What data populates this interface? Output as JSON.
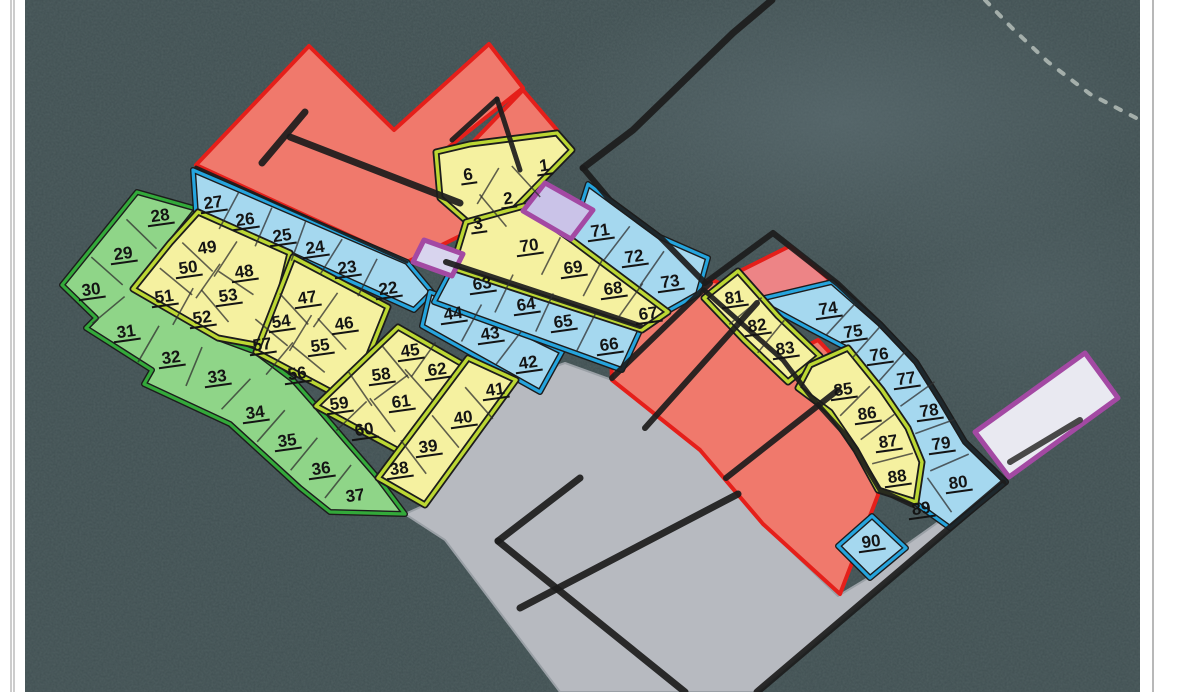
{
  "map": {
    "width": 1179,
    "height": 692,
    "description": "Subdivision plot plan over aerial forest photo, numbered land parcels",
    "colors": {
      "page_bg": "#ffffff",
      "forest": "#414f52",
      "forest_light": "#5d6d6e",
      "gray": "#b7bac0",
      "gray_edge": "#9aa0a6",
      "red_fill": "#f0796c",
      "red_fill_alt": "#ed8486",
      "red_stroke": "#e51f1a",
      "yellow_fill": "#f5f1a0",
      "yellow_stroke": "#bcd733",
      "blue_fill": "#a5d8ef",
      "blue_stroke": "#25a4dd",
      "green_fill": "#8fd588",
      "green_stroke": "#33a93a",
      "purple_stroke": "#a349a3",
      "purple_fill_1": "#cac3e8",
      "purple_fill_2": "#d8d4ee",
      "purple_fill_3": "#e9e9f1",
      "road": "#1c1c1c",
      "divider": "#2f2f2f",
      "label": "#141414",
      "trail": "#d6ddd6",
      "margin_line": "#999999"
    },
    "zones": [
      {
        "id": "gray-clearing",
        "sty": "gray",
        "pts": "565,363 612,380 700,450 763,524 838,596 868,578 906,545 958,508 1003,483 757,692 560,692 445,540 405,514 425,505 516,380"
      },
      {
        "id": "red-north-M",
        "sty": "red",
        "pts": "196,165 309,46 394,130 489,44 523,88 445,150 500,190 540,238 468,232 407,262"
      },
      {
        "id": "red-north-band",
        "sty": "red",
        "pts": "523,90 557,130 505,173 472,143"
      },
      {
        "id": "red-middle",
        "sty": "red",
        "pts": "609,301 652,282 715,281 757,302 800,348 838,387 860,416 875,460 878,495 840,594 763,524 700,450 612,380"
      },
      {
        "id": "red-east-top",
        "sty": "red",
        "fill": "#ed8486",
        "pts": "738,272 790,246 830,280 776,318"
      },
      {
        "id": "red-east-mid",
        "sty": "red",
        "pts": "786,356 818,340 848,372 815,395"
      },
      {
        "id": "green-band",
        "sty": "green",
        "pts": "137,192 62,285 96,318 86,328 152,370 144,384 230,424 300,488 330,512 405,514 378,478 345,440 316,406 293,380 256,352 218,338 196,320 133,289 170,243 197,209"
      },
      {
        "id": "blue-band-22-27",
        "sty": "blue",
        "pts": "193,170 407,262 432,292 414,310 290,254 196,214"
      },
      {
        "id": "blue-band-42-44",
        "sty": "blue",
        "pts": "430,292 468,306 562,352 540,392 422,326"
      },
      {
        "id": "blue-band-63-66",
        "sty": "blue",
        "pts": "454,264 644,322 622,370 434,302"
      },
      {
        "id": "blue-band-71-73",
        "sty": "blue",
        "pts": "588,184 660,237 708,258 698,294 666,312 570,240"
      },
      {
        "id": "blue-band-74-80",
        "sty": "blue",
        "pts": "756,300 832,282 880,324 916,362 940,400 965,442 1006,482 950,528 914,502 920,462 906,428 880,390 846,348 808,328"
      },
      {
        "id": "blue-plot-90",
        "sty": "blue",
        "pts": "838,546 872,516 906,548 870,578"
      },
      {
        "id": "yellow-block-49-53",
        "sty": "yellow",
        "pts": "198,212 290,253 267,347 218,338 133,289 170,243"
      },
      {
        "id": "yellow-block-46-57",
        "sty": "yellow",
        "pts": "293,257 388,307 350,402 256,352"
      },
      {
        "id": "yellow-block-45-62",
        "sty": "yellow",
        "pts": "398,327 466,366 430,468 316,406"
      },
      {
        "id": "yellow-block-38-41",
        "sty": "yellow",
        "pts": "468,358 516,380 425,505 378,478"
      },
      {
        "id": "yellow-block-1-6",
        "sty": "yellow",
        "pts": "436,152 470,144 557,133 572,150 486,238 440,198"
      },
      {
        "id": "yellow-band-67-70",
        "sty": "yellow",
        "pts": "466,222 524,206 572,240 668,312 642,330 452,268"
      },
      {
        "id": "yellow-band-81-83",
        "sty": "yellow",
        "pts": "704,298 738,271 778,316 820,356 788,382 744,340"
      },
      {
        "id": "yellow-band-85-88",
        "sty": "yellow",
        "pts": "810,365 848,348 882,390 908,428 922,462 916,502 878,490 856,450 830,412 798,388"
      },
      {
        "id": "purple-plot-north",
        "sty": "purple",
        "fill": "#cac3e8",
        "pts": "545,183 593,210 571,239 523,211"
      },
      {
        "id": "purple-plot-small",
        "sty": "purple",
        "fill": "#d8d4ee",
        "pts": "424,240 463,254 452,276 413,262"
      },
      {
        "id": "purple-plot-east",
        "sty": "purple",
        "fill": "#e9e9f1",
        "pts": "1085,353 1118,398 1009,477 975,432"
      }
    ],
    "roads": [
      {
        "id": "road-top-diagonal",
        "pts": "772,0 733,33 633,130 583,168",
        "w": 7
      },
      {
        "id": "road-ne-71-73",
        "pts": "583,168 610,200 660,237 705,283",
        "w": 6
      },
      {
        "id": "road-ne-boundary",
        "pts": "705,283 773,233 838,284 880,324 916,362 940,400 965,442 993,469 1006,482",
        "w": 6
      },
      {
        "id": "road-red-strip-boundary",
        "pts": "704,290 783,360 812,398 850,440 880,490 912,505",
        "w": 5
      },
      {
        "id": "road-band-63",
        "pts": "446,262 640,326",
        "w": 6
      },
      {
        "id": "road-red-blue-edge",
        "pts": "196,167 407,262",
        "w": 3
      },
      {
        "id": "road-red-T-short",
        "pts": "262,163 305,112",
        "w": 7
      },
      {
        "id": "road-red-T-long",
        "pts": "290,137 460,203",
        "w": 7
      },
      {
        "id": "road-red-r1",
        "pts": "452,140 497,99",
        "w": 5
      },
      {
        "id": "road-red-r2",
        "pts": "497,99 520,170",
        "w": 5
      },
      {
        "id": "road-redmid-s1",
        "pts": "710,283 612,378",
        "w": 6
      },
      {
        "id": "road-redmid-s2",
        "pts": "757,303 645,428",
        "w": 6
      },
      {
        "id": "road-redmid-s3",
        "pts": "838,390 726,478",
        "w": 6
      },
      {
        "id": "road-gray-a",
        "pts": "580,478 498,541",
        "w": 7
      },
      {
        "id": "road-gray-b",
        "pts": "498,541 685,692",
        "w": 7
      },
      {
        "id": "road-gray-c",
        "pts": "520,608 738,494",
        "w": 7
      },
      {
        "id": "road-gray-d",
        "pts": "757,692 1003,483",
        "w": 7
      },
      {
        "id": "road-purple-east-inner",
        "pts": "1080,420 1010,462",
        "w": 6,
        "c": "#3a3a3a"
      }
    ],
    "trail": {
      "id": "forest-trail",
      "pts": "985,0 1012,28 1048,62 1090,94 1140,120",
      "dash": "6 11",
      "w": 4
    },
    "plots": [
      [
        "1",
        544,
        165,
        "y",
        1
      ],
      [
        "2",
        508,
        198,
        "y",
        1
      ],
      [
        "3",
        478,
        223,
        "y",
        1
      ],
      [
        "6",
        468,
        174,
        "y",
        1
      ],
      [
        "22",
        388,
        288,
        "b",
        1
      ],
      [
        "23",
        347,
        267,
        "b",
        1
      ],
      [
        "24",
        315,
        247,
        "b",
        1
      ],
      [
        "25",
        282,
        235,
        "b",
        1
      ],
      [
        "26",
        245,
        219,
        "b",
        1
      ],
      [
        "27",
        213,
        202,
        "b",
        1
      ],
      [
        "28",
        160,
        215,
        "g",
        1
      ],
      [
        "29",
        123,
        253,
        "g",
        1
      ],
      [
        "30",
        91,
        289,
        "g",
        1
      ],
      [
        "31",
        126,
        331,
        "g",
        1
      ],
      [
        "32",
        171,
        357,
        "g",
        1
      ],
      [
        "33",
        217,
        376,
        "g",
        1
      ],
      [
        "34",
        255,
        412,
        "g",
        1
      ],
      [
        "35",
        287,
        440,
        "g",
        1
      ],
      [
        "36",
        321,
        468,
        "g",
        1
      ],
      [
        "37",
        355,
        495,
        "g",
        0
      ],
      [
        "38",
        399,
        468,
        "y",
        1
      ],
      [
        "39",
        428,
        446,
        "y",
        1
      ],
      [
        "40",
        463,
        417,
        "y",
        1
      ],
      [
        "41",
        495,
        389,
        "y",
        1
      ],
      [
        "42",
        528,
        362,
        "b",
        1
      ],
      [
        "43",
        490,
        333,
        "b",
        1
      ],
      [
        "44",
        453,
        313,
        "b",
        1
      ],
      [
        "45",
        410,
        350,
        "y",
        1
      ],
      [
        "46",
        344,
        323,
        "y",
        1
      ],
      [
        "47",
        307,
        297,
        "y",
        1
      ],
      [
        "48",
        244,
        271,
        "y",
        1
      ],
      [
        "49",
        207,
        247,
        "y",
        0
      ],
      [
        "50",
        188,
        267,
        "y",
        1
      ],
      [
        "51",
        164,
        296,
        "y",
        1
      ],
      [
        "52",
        202,
        317,
        "y",
        1
      ],
      [
        "53",
        228,
        295,
        "y",
        1
      ],
      [
        "54",
        281,
        321,
        "y",
        1
      ],
      [
        "55",
        320,
        345,
        "y",
        1
      ],
      [
        "56",
        297,
        373,
        "y",
        1
      ],
      [
        "57",
        262,
        344,
        "y",
        1
      ],
      [
        "58",
        381,
        374,
        "y",
        1
      ],
      [
        "59",
        339,
        403,
        "y",
        1
      ],
      [
        "60",
        364,
        429,
        "y",
        1
      ],
      [
        "61",
        401,
        401,
        "y",
        1
      ],
      [
        "62",
        437,
        369,
        "y",
        1
      ],
      [
        "63",
        482,
        283,
        "b",
        1
      ],
      [
        "64",
        526,
        304,
        "b",
        1
      ],
      [
        "65",
        563,
        321,
        "b",
        1
      ],
      [
        "66",
        609,
        344,
        "b",
        1
      ],
      [
        "67",
        648,
        313,
        "y",
        1
      ],
      [
        "68",
        613,
        288,
        "y",
        1
      ],
      [
        "69",
        573,
        267,
        "y",
        1
      ],
      [
        "70",
        529,
        245,
        "y",
        1
      ],
      [
        "71",
        600,
        230,
        "b",
        1
      ],
      [
        "72",
        634,
        256,
        "b",
        1
      ],
      [
        "73",
        670,
        281,
        "b",
        1
      ],
      [
        "74",
        828,
        308,
        "b",
        1
      ],
      [
        "75",
        853,
        331,
        "b",
        1
      ],
      [
        "76",
        879,
        354,
        "b",
        1
      ],
      [
        "77",
        906,
        378,
        "b",
        1
      ],
      [
        "78",
        929,
        410,
        "b",
        1
      ],
      [
        "79",
        941,
        443,
        "b",
        1
      ],
      [
        "80",
        958,
        482,
        "b",
        1
      ],
      [
        "81",
        734,
        297,
        "y",
        1
      ],
      [
        "82",
        757,
        325,
        "y",
        1
      ],
      [
        "83",
        785,
        348,
        "y",
        1
      ],
      [
        "85",
        843,
        389,
        "y",
        1
      ],
      [
        "86",
        867,
        413,
        "y",
        1
      ],
      [
        "87",
        888,
        441,
        "y",
        1
      ],
      [
        "88",
        897,
        476,
        "y",
        1
      ],
      [
        "89",
        921,
        508,
        "b",
        1
      ],
      [
        "90",
        871,
        541,
        "b",
        1
      ]
    ],
    "dividers": [
      [
        "28",
        "29"
      ],
      [
        "29",
        "30"
      ],
      [
        "30",
        "31"
      ],
      [
        "31",
        "32"
      ],
      [
        "32",
        "33"
      ],
      [
        "33",
        "34"
      ],
      [
        "34",
        "35"
      ],
      [
        "35",
        "36"
      ],
      [
        "36",
        "37"
      ],
      [
        "27",
        "26"
      ],
      [
        "26",
        "25"
      ],
      [
        "25",
        "24"
      ],
      [
        "24",
        "23"
      ],
      [
        "23",
        "22"
      ],
      [
        "49",
        "48"
      ],
      [
        "50",
        "53"
      ],
      [
        "51",
        "52"
      ],
      [
        "49",
        "50"
      ],
      [
        "48",
        "53"
      ],
      [
        "50",
        "51"
      ],
      [
        "53",
        "52"
      ],
      [
        "47",
        "46"
      ],
      [
        "54",
        "55"
      ],
      [
        "57",
        "56"
      ],
      [
        "47",
        "54"
      ],
      [
        "54",
        "57"
      ],
      [
        "46",
        "55"
      ],
      [
        "55",
        "56"
      ],
      [
        "45",
        "62"
      ],
      [
        "58",
        "61"
      ],
      [
        "59",
        "60"
      ],
      [
        "45",
        "58"
      ],
      [
        "58",
        "59"
      ],
      [
        "62",
        "61"
      ],
      [
        "61",
        "60"
      ],
      [
        "41",
        "40"
      ],
      [
        "40",
        "39"
      ],
      [
        "39",
        "38"
      ],
      [
        "6",
        "2"
      ],
      [
        "2",
        "1"
      ],
      [
        "3",
        "2"
      ],
      [
        "70",
        "69"
      ],
      [
        "69",
        "68"
      ],
      [
        "68",
        "67"
      ],
      [
        "63",
        "64"
      ],
      [
        "64",
        "65"
      ],
      [
        "65",
        "66"
      ],
      [
        "44",
        "43"
      ],
      [
        "43",
        "42"
      ],
      [
        "71",
        "72"
      ],
      [
        "72",
        "73"
      ],
      [
        "74",
        "75"
      ],
      [
        "75",
        "76"
      ],
      [
        "76",
        "77"
      ],
      [
        "77",
        "78"
      ],
      [
        "78",
        "79"
      ],
      [
        "79",
        "80"
      ],
      [
        "80",
        "89"
      ],
      [
        "81",
        "82"
      ],
      [
        "82",
        "83"
      ],
      [
        "85",
        "86"
      ],
      [
        "86",
        "87"
      ],
      [
        "87",
        "88"
      ]
    ],
    "margins": {
      "left_width": 25,
      "left_lines_x": [
        11,
        14
      ],
      "right_start": 1140,
      "right_line_x": 1153
    }
  }
}
